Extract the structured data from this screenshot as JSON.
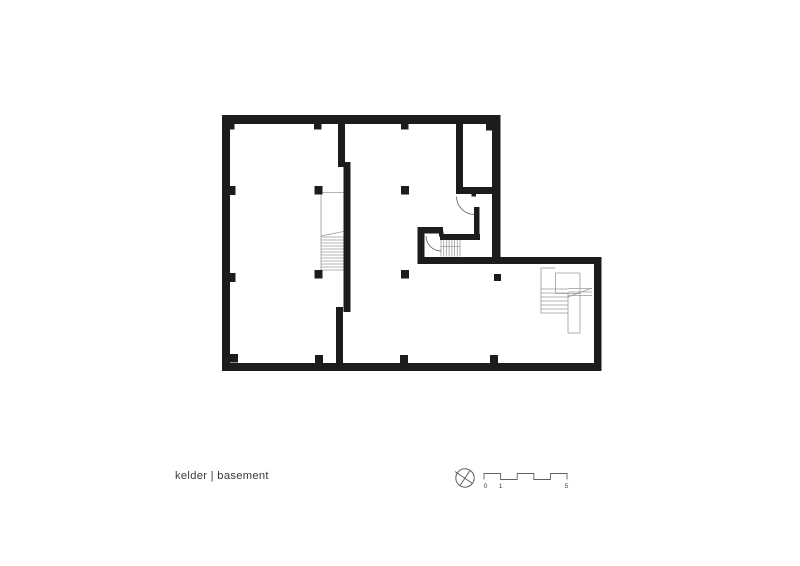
{
  "page": {
    "width": 800,
    "height": 566,
    "background": "#ffffff"
  },
  "title": {
    "label": "kelder | basement"
  },
  "colors": {
    "wall": "#1c1c1c",
    "stair_line": "#9a9a9a",
    "door_line": "#6f6f6f",
    "scale_line": "#5f5f5f",
    "label_text": "#4a4a4a",
    "title_text": "#3a3a3a"
  },
  "scale_bar": {
    "labels": [
      "0",
      "1",
      "5"
    ],
    "polyline": "484,479.5 484,473.5 500.6,473.5 500.6,479.5 517.2,479.5 517.2,473.5 533.8,473.5 533.8,479.5 550.4,479.5 550.4,473.5 567,473.5 567,479.5"
  },
  "north_symbol": {
    "cx": 465,
    "cy": 478,
    "r": 9.2,
    "lines": [
      [
        455,
        471.5,
        472.5,
        483.5
      ],
      [
        460,
        485.5,
        470,
        470.5
      ]
    ]
  },
  "plan": {
    "walls": [
      [
        222,
        115,
        278.5,
        9
      ],
      [
        222,
        115,
        8,
        256
      ],
      [
        222,
        363,
        379.5,
        8
      ],
      [
        492,
        115,
        8.5,
        149
      ],
      [
        417.5,
        257,
        184,
        7
      ],
      [
        594,
        257,
        7.5,
        114
      ],
      [
        338,
        115,
        7,
        52
      ],
      [
        343.5,
        162,
        7,
        150
      ],
      [
        336,
        307,
        7,
        64
      ],
      [
        456,
        115,
        7,
        79
      ],
      [
        456,
        187,
        44.5,
        7
      ],
      [
        474,
        207,
        5.5,
        33
      ],
      [
        440,
        234,
        40,
        6
      ],
      [
        417.5,
        227,
        25.5,
        6.5
      ],
      [
        417.5,
        227,
        7,
        37
      ]
    ],
    "columns": [
      [
        314,
        121,
        7.5,
        8.5
      ],
      [
        401,
        121,
        7.5,
        8.5
      ],
      [
        229,
        122,
        5.5,
        7.5
      ],
      [
        486,
        122,
        7,
        8.5
      ],
      [
        230,
        186,
        5.5,
        9
      ],
      [
        230,
        273,
        5.5,
        9
      ],
      [
        314.5,
        186,
        8,
        8.5
      ],
      [
        401,
        186,
        8,
        8.5
      ],
      [
        314.5,
        270,
        8,
        8.5
      ],
      [
        401,
        270,
        8,
        8.5
      ],
      [
        494,
        274,
        7,
        7
      ],
      [
        315,
        355,
        8,
        8
      ],
      [
        400,
        355,
        8,
        8
      ],
      [
        490,
        355,
        8,
        8
      ],
      [
        230,
        354,
        8,
        8.5
      ]
    ],
    "doors": [
      {
        "jamb": [
          471.5,
          191,
          4.5,
          5.5
        ],
        "arc": "M 456.5 196.5 A 18 18 0 0 0 474.5 214.5"
      },
      {
        "jamb": [
          439,
          231.5,
          4.5,
          5
        ],
        "arc": "M 426 236 A 15 15 0 0 0 441 251"
      }
    ],
    "stair_lines": [
      [
        321,
        192.5,
        321,
        271
      ],
      [
        321,
        192.5,
        343.5,
        192.5
      ],
      [
        321,
        236,
        343.5,
        231.5
      ],
      [
        321,
        237,
        343.5,
        237
      ],
      [
        321,
        240,
        343.5,
        240
      ],
      [
        321,
        243,
        343.5,
        243
      ],
      [
        321,
        246,
        343.5,
        246
      ],
      [
        321,
        249,
        343.5,
        249
      ],
      [
        321,
        252,
        343.5,
        252
      ],
      [
        321,
        255,
        343.5,
        255
      ],
      [
        321,
        258,
        343.5,
        258
      ],
      [
        321,
        261,
        343.5,
        261
      ],
      [
        321,
        264,
        343.5,
        264
      ],
      [
        321,
        267,
        343.5,
        267
      ],
      [
        321,
        270,
        343.5,
        270
      ],
      [
        441,
        240,
        441,
        256.5
      ],
      [
        443.7,
        240,
        443.7,
        256.5
      ],
      [
        446.4,
        240,
        446.4,
        256.5
      ],
      [
        449.1,
        240,
        449.1,
        256.5
      ],
      [
        451.9,
        240,
        451.9,
        256.5
      ],
      [
        454.6,
        240,
        454.6,
        256.5
      ],
      [
        457.3,
        240,
        457.3,
        256.5
      ],
      [
        460,
        240,
        460,
        256.5
      ],
      [
        441,
        246.5,
        460,
        246.5
      ],
      [
        541,
        268,
        541,
        313
      ],
      [
        541,
        268,
        555.5,
        268
      ],
      [
        555.5,
        273,
        580,
        273
      ],
      [
        555.5,
        273,
        555.5,
        293.5
      ],
      [
        555.5,
        293.5,
        580,
        293.5
      ],
      [
        541,
        289,
        568,
        289
      ],
      [
        541,
        293,
        568,
        293
      ],
      [
        541,
        297,
        568,
        297
      ],
      [
        541,
        301,
        568,
        301
      ],
      [
        541,
        305,
        568,
        305
      ],
      [
        541,
        309,
        568,
        309
      ],
      [
        541,
        313,
        568,
        313
      ],
      [
        568,
        288.5,
        592,
        288.5
      ],
      [
        568,
        292,
        592,
        292
      ],
      [
        568,
        295.5,
        592,
        295.5
      ],
      [
        568,
        297,
        592,
        288
      ],
      [
        568,
        293.5,
        568,
        333
      ],
      [
        580,
        273,
        580,
        333
      ],
      [
        568,
        333,
        580,
        333
      ]
    ]
  }
}
